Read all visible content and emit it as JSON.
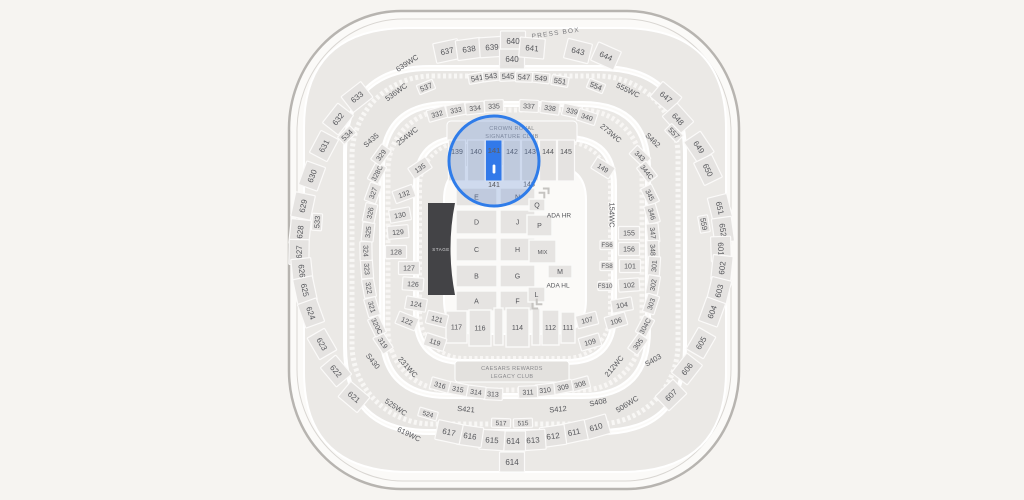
{
  "map": {
    "texts": {
      "press_box": "PRESS BOX",
      "crown_royal": [
        "CROWN ROYAL",
        "SIGNATURE CLUB"
      ],
      "legacy": [
        "CAESARS REWARDS",
        "LEGACY CLUB"
      ],
      "stage": "STAGE"
    },
    "colors": {
      "background": "#f6f4f1",
      "section_box": "#e5e3e1",
      "section_text": "#55565a",
      "highlight": "#2273f2",
      "circle_stroke": "#2f7ce9",
      "circle_fill_rgba": "rgba(92,138,212,0.28)"
    },
    "selected_section": {
      "label": "141",
      "bottom_label": "141"
    },
    "zoom_circle": {
      "cx": 494,
      "cy": 161,
      "r": 45
    },
    "upper_floor_sections": [
      [
        "139",
        457
      ],
      [
        "140",
        476
      ],
      [
        "142",
        512
      ],
      [
        "143",
        530
      ],
      [
        "144",
        548
      ],
      [
        "145",
        566
      ]
    ],
    "floor_boxes": [
      [
        "E",
        456,
        188,
        41,
        18
      ],
      [
        "N",
        500,
        188,
        35,
        18
      ],
      [
        "D",
        456,
        210,
        41,
        24
      ],
      [
        "J",
        500,
        210,
        35,
        24
      ],
      [
        "C",
        456,
        238,
        41,
        23
      ],
      [
        "H",
        500,
        238,
        35,
        23
      ],
      [
        "B",
        456,
        265,
        41,
        22
      ],
      [
        "G",
        500,
        265,
        35,
        22
      ],
      [
        "A",
        456,
        291,
        41,
        20
      ],
      [
        "F",
        500,
        291,
        35,
        20
      ],
      [
        "Q",
        529,
        199,
        16,
        12
      ],
      [
        "P",
        527,
        215,
        25,
        21
      ],
      [
        "MIX",
        529,
        240,
        27,
        23
      ],
      [
        "M",
        548,
        265,
        24,
        13
      ],
      [
        "L",
        528,
        287,
        17,
        15
      ],
      [
        "117",
        446,
        311,
        21,
        32
      ],
      [
        "116",
        469,
        310,
        22,
        36
      ],
      [
        "",
        494,
        308,
        9,
        37
      ],
      [
        "114",
        506,
        308,
        23,
        39
      ],
      [
        "",
        532,
        308,
        8,
        37
      ],
      [
        "112",
        542,
        310,
        17,
        35
      ],
      [
        "111",
        561,
        312,
        14,
        31
      ]
    ],
    "sections": [
      [
        "633",
        357,
        97,
        -38,
        "s600"
      ],
      [
        "632",
        338,
        119,
        -52,
        "s600"
      ],
      [
        "631",
        324,
        146,
        -62,
        "s600"
      ],
      [
        "630",
        312,
        176,
        -70,
        "s600"
      ],
      [
        "629",
        303,
        206,
        -78,
        "s600"
      ],
      [
        "628",
        300,
        232,
        -84,
        "s600"
      ],
      [
        "627",
        299,
        252,
        -89,
        "s600"
      ],
      [
        "626",
        302,
        271,
        84,
        "s600"
      ],
      [
        "625",
        305,
        290,
        78,
        "s600"
      ],
      [
        "624",
        311,
        313,
        70,
        "s600"
      ],
      [
        "623",
        322,
        344,
        60,
        "s600"
      ],
      [
        "622",
        336,
        371,
        50,
        "s600"
      ],
      [
        "621",
        354,
        397,
        40,
        "s600"
      ],
      [
        "637",
        447,
        51,
        -12,
        "s600"
      ],
      [
        "638",
        469,
        49,
        -8,
        "s600"
      ],
      [
        "639",
        492,
        47,
        -4,
        "s600"
      ],
      [
        "640",
        513,
        41,
        0,
        "s600"
      ],
      [
        "640",
        512,
        59,
        0,
        "s600"
      ],
      [
        "641",
        532,
        48,
        5,
        "s600"
      ],
      [
        "643",
        578,
        51,
        14,
        "s600"
      ],
      [
        "644",
        606,
        56,
        24,
        "s600"
      ],
      [
        "647",
        666,
        97,
        40,
        "s600"
      ],
      [
        "648",
        678,
        119,
        48,
        "s600"
      ],
      [
        "649",
        699,
        147,
        56,
        "s600"
      ],
      [
        "650",
        708,
        170,
        64,
        "s600"
      ],
      [
        "651",
        720,
        208,
        76,
        "s600"
      ],
      [
        "652",
        723,
        230,
        82,
        "s600"
      ],
      [
        "601",
        721,
        249,
        88,
        "s600"
      ],
      [
        "602",
        722,
        268,
        -84,
        "s600"
      ],
      [
        "603",
        719,
        291,
        -76,
        "s600"
      ],
      [
        "604",
        712,
        312,
        -70,
        "s600"
      ],
      [
        "605",
        701,
        343,
        -60,
        "s600"
      ],
      [
        "606",
        687,
        369,
        -52,
        "s600"
      ],
      [
        "607",
        671,
        395,
        -44,
        "s600"
      ],
      [
        "610",
        596,
        427,
        -16,
        "s600"
      ],
      [
        "611",
        574,
        432,
        -12,
        "s600"
      ],
      [
        "612",
        553,
        436,
        -8,
        "s600"
      ],
      [
        "613",
        533,
        440,
        -4,
        "s600"
      ],
      [
        "614",
        513,
        441,
        0,
        "s600"
      ],
      [
        "614",
        512,
        462,
        0,
        "s600"
      ],
      [
        "615",
        492,
        440,
        4,
        "s600"
      ],
      [
        "616",
        470,
        436,
        8,
        "s600"
      ],
      [
        "617",
        449,
        432,
        12,
        "s600"
      ],
      [
        "537",
        426,
        87,
        -22,
        "s500"
      ],
      [
        "541",
        477,
        78,
        -10,
        "s500"
      ],
      [
        "543",
        491,
        76,
        -7,
        "s500"
      ],
      [
        "545",
        508,
        76,
        -3,
        "s500"
      ],
      [
        "547",
        524,
        77,
        2,
        "s500"
      ],
      [
        "549",
        541,
        78,
        6,
        "s500"
      ],
      [
        "551",
        560,
        81,
        10,
        "s500"
      ],
      [
        "554",
        596,
        86,
        22,
        "s500"
      ],
      [
        "557",
        674,
        133,
        46,
        "s500"
      ],
      [
        "559",
        704,
        224,
        80,
        "s500"
      ],
      [
        "533",
        317,
        222,
        -86,
        "s500"
      ],
      [
        "534",
        347,
        135,
        -44,
        "s500"
      ],
      [
        "517",
        501,
        423,
        2,
        "sm"
      ],
      [
        "515",
        523,
        423,
        -2,
        "sm"
      ],
      [
        "524",
        428,
        414,
        16,
        "sm"
      ],
      [
        "S435",
        371,
        140,
        -42,
        "sw"
      ],
      [
        "S462",
        653,
        140,
        44,
        "sw"
      ],
      [
        "S430",
        373,
        361,
        52,
        "sw"
      ],
      [
        "S421",
        466,
        409,
        5,
        "sw"
      ],
      [
        "S412",
        558,
        409,
        -5,
        "sw"
      ],
      [
        "S408",
        598,
        402,
        -12,
        "sw"
      ],
      [
        "S403",
        653,
        360,
        -30,
        "sw"
      ],
      [
        "639WC",
        407,
        63,
        -33,
        "wc"
      ],
      [
        "536WC",
        396,
        92,
        -36,
        "wc"
      ],
      [
        "254WC",
        407,
        136,
        -38,
        "wc"
      ],
      [
        "555WC",
        628,
        90,
        26,
        "wc"
      ],
      [
        "273WC",
        611,
        133,
        40,
        "wc"
      ],
      [
        "154WC",
        612,
        215,
        90,
        "wc"
      ],
      [
        "231WC",
        408,
        367,
        48,
        "wc"
      ],
      [
        "525WC",
        396,
        407,
        34,
        "wc"
      ],
      [
        "619WC",
        409,
        434,
        26,
        "wc"
      ],
      [
        "212WC",
        614,
        366,
        -50,
        "wc"
      ],
      [
        "506WC",
        627,
        404,
        -32,
        "wc"
      ],
      [
        "332",
        437,
        114,
        -16,
        "s300"
      ],
      [
        "333",
        456,
        110,
        -11,
        "s300"
      ],
      [
        "334",
        475,
        108,
        -6,
        "s300"
      ],
      [
        "335",
        494,
        106,
        -2,
        "s300"
      ],
      [
        "337",
        529,
        106,
        3,
        "s300"
      ],
      [
        "338",
        550,
        108,
        8,
        "s300"
      ],
      [
        "339",
        572,
        111,
        13,
        "s300"
      ],
      [
        "340",
        587,
        117,
        18,
        "s300"
      ],
      [
        "343",
        640,
        156,
        44,
        "s300"
      ],
      [
        "344C",
        647,
        172,
        52,
        "s300"
      ],
      [
        "345",
        650,
        195,
        64,
        "s300"
      ],
      [
        "346",
        652,
        214,
        74,
        "s300"
      ],
      [
        "347",
        653,
        233,
        84,
        "s300"
      ],
      [
        "348",
        653,
        250,
        88,
        "s300"
      ],
      [
        "301",
        654,
        266,
        -86,
        "s300"
      ],
      [
        "302",
        653,
        285,
        -80,
        "s300"
      ],
      [
        "303",
        651,
        304,
        -72,
        "s300"
      ],
      [
        "304C",
        645,
        326,
        -62,
        "s300"
      ],
      [
        "305",
        638,
        344,
        -54,
        "s300"
      ],
      [
        "308",
        580,
        384,
        -15,
        "s300"
      ],
      [
        "309",
        563,
        387,
        -11,
        "s300"
      ],
      [
        "310",
        545,
        390,
        -6,
        "s300"
      ],
      [
        "311",
        528,
        392,
        -2,
        "s300"
      ],
      [
        "313",
        493,
        394,
        3,
        "s300"
      ],
      [
        "314",
        476,
        392,
        7,
        "s300"
      ],
      [
        "315",
        458,
        389,
        11,
        "s300"
      ],
      [
        "316",
        440,
        385,
        15,
        "s300"
      ],
      [
        "319",
        383,
        343,
        56,
        "s300"
      ],
      [
        "320C",
        377,
        326,
        64,
        "s300"
      ],
      [
        "321",
        372,
        307,
        74,
        "s300"
      ],
      [
        "322",
        369,
        288,
        80,
        "s300"
      ],
      [
        "323",
        367,
        269,
        86,
        "s300"
      ],
      [
        "324",
        366,
        251,
        89,
        "s300"
      ],
      [
        "325",
        368,
        232,
        -84,
        "s300"
      ],
      [
        "326",
        370,
        213,
        -78,
        "s300"
      ],
      [
        "327",
        373,
        193,
        -70,
        "s300"
      ],
      [
        "328C",
        377,
        173,
        -62,
        "s300"
      ],
      [
        "329",
        381,
        155,
        -54,
        "s300"
      ],
      [
        "135",
        420,
        168,
        -34,
        "s100"
      ],
      [
        "132",
        404,
        194,
        -20,
        "s100"
      ],
      [
        "130",
        400,
        215,
        -10,
        "s100"
      ],
      [
        "129",
        398,
        232,
        -5,
        "s100"
      ],
      [
        "128",
        396,
        252,
        0,
        "s100"
      ],
      [
        "127",
        409,
        268,
        0,
        "s100"
      ],
      [
        "126",
        413,
        284,
        4,
        "s100"
      ],
      [
        "124",
        416,
        304,
        10,
        "s100"
      ],
      [
        "122",
        407,
        321,
        22,
        "s100"
      ],
      [
        "121",
        437,
        319,
        14,
        "s100"
      ],
      [
        "119",
        435,
        342,
        18,
        "s100"
      ],
      [
        "149",
        603,
        168,
        32,
        "s100"
      ],
      [
        "155",
        629,
        233,
        0,
        "s100"
      ],
      [
        "156",
        629,
        249,
        0,
        "s100"
      ],
      [
        "101",
        630,
        266,
        0,
        "s100"
      ],
      [
        "102",
        629,
        285,
        -4,
        "s100"
      ],
      [
        "104",
        622,
        305,
        -10,
        "s100"
      ],
      [
        "106",
        616,
        321,
        -16,
        "s100"
      ],
      [
        "107",
        587,
        320,
        -14,
        "s100"
      ],
      [
        "109",
        590,
        342,
        -16,
        "s100"
      ],
      [
        "FS6",
        607,
        245,
        0,
        "fs"
      ],
      [
        "FS8",
        607,
        266,
        0,
        "fs"
      ],
      [
        "FS10",
        605,
        286,
        0,
        "fs"
      ],
      [
        "143",
        529,
        184,
        0,
        "plain"
      ],
      [
        "ADA HR",
        559,
        215,
        0,
        "ftext"
      ],
      [
        "ADA HL",
        558,
        285,
        0,
        "ftext"
      ]
    ]
  }
}
